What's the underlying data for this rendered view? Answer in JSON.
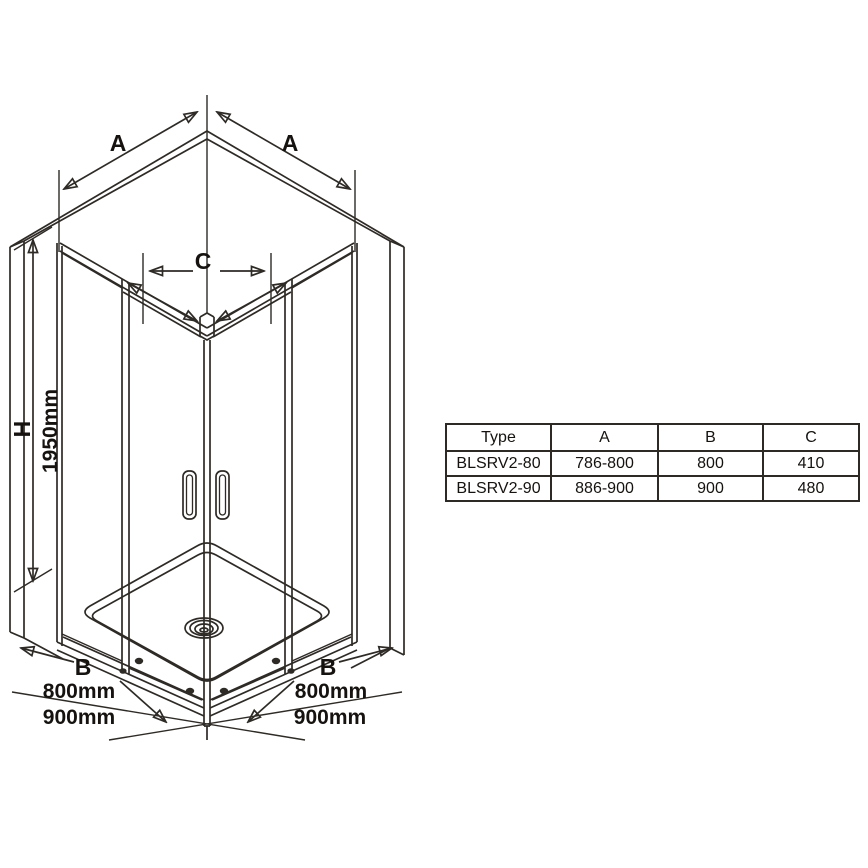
{
  "colors": {
    "line": "#2e2a26",
    "text": "#15120f",
    "background": "#ffffff"
  },
  "diagram": {
    "description": "isometric line drawing of corner-entry shower enclosure with two sliding doors, shower tray and drain",
    "labels": {
      "a_left": "A",
      "a_right": "A",
      "c": "C",
      "h": "H",
      "h_value": "1950mm",
      "b_left": "B",
      "left_800": "800mm",
      "left_900": "900mm",
      "b_right": "B",
      "right_800": "800mm",
      "right_900": "900mm"
    }
  },
  "table": {
    "headers": [
      "Type",
      "A",
      "B",
      "C"
    ],
    "rows": [
      [
        "BLSRV2-80",
        "786-800",
        "800",
        "410"
      ],
      [
        "BLSRV2-90",
        "886-900",
        "900",
        "480"
      ]
    ]
  }
}
